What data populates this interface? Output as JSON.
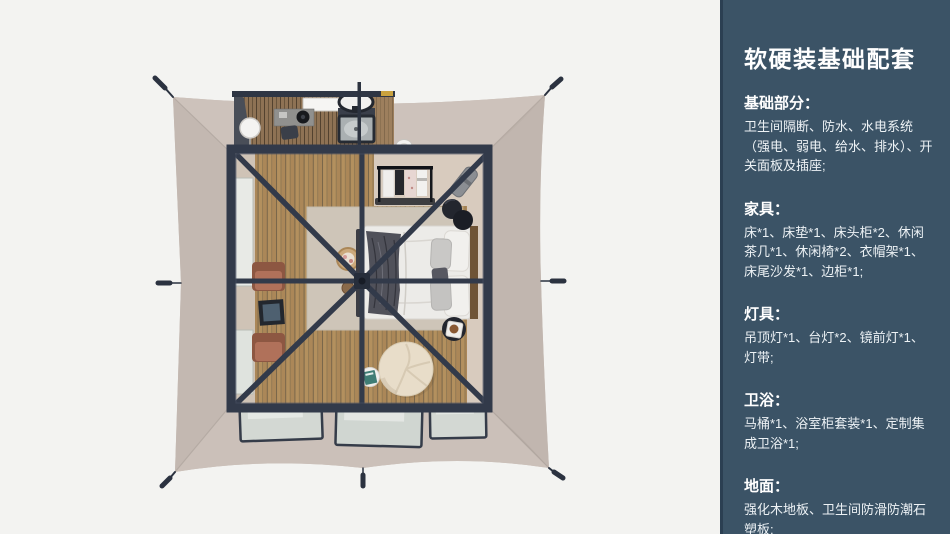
{
  "panel": {
    "title": "软硬装基础配套",
    "sections": [
      {
        "heading": "基础部分：",
        "body": "卫生间隔断、防水、水电系统（强电、弱电、给水、排水）、开关面板及插座;"
      },
      {
        "heading": "家具：",
        "body": "床*1、床垫*1、床头柜*2、休闲茶几*1、休闲椅*2、衣帽架*1、床尾沙发*1、边柜*1;"
      },
      {
        "heading": "灯具：",
        "body": "吊顶灯*1、台灯*2、镜前灯*1、灯带;"
      },
      {
        "heading": "卫浴：",
        "body": "马桶*1、浴室柜套装*1、定制集成卫浴*1;"
      },
      {
        "heading": "地面：",
        "body": "强化木地板、卫生间防滑防潮石塑板;"
      }
    ]
  },
  "illustration": {
    "description": "Top-down 3D rendering of a square glamping tent: beige canvas with corner guy stakes, dark frame with diagonal ridge beams, bathroom module at top, wood plank floor, bed with white duvet and dark throw, two terracotta lounge chairs, clothes rack, round ottoman",
    "colors": {
      "page_background": "#f3f3f1",
      "panel_background": "#3b5366",
      "panel_edge": "#2b3f52",
      "tent_canvas": "#c9beb7",
      "frame_navy": "#323a4a",
      "wood_floor": "#b3905e",
      "interior_beige": "#d8cbbe",
      "chair_terracotta": "#b0715a",
      "accent_towel_yellow": "#c9a23f"
    }
  }
}
